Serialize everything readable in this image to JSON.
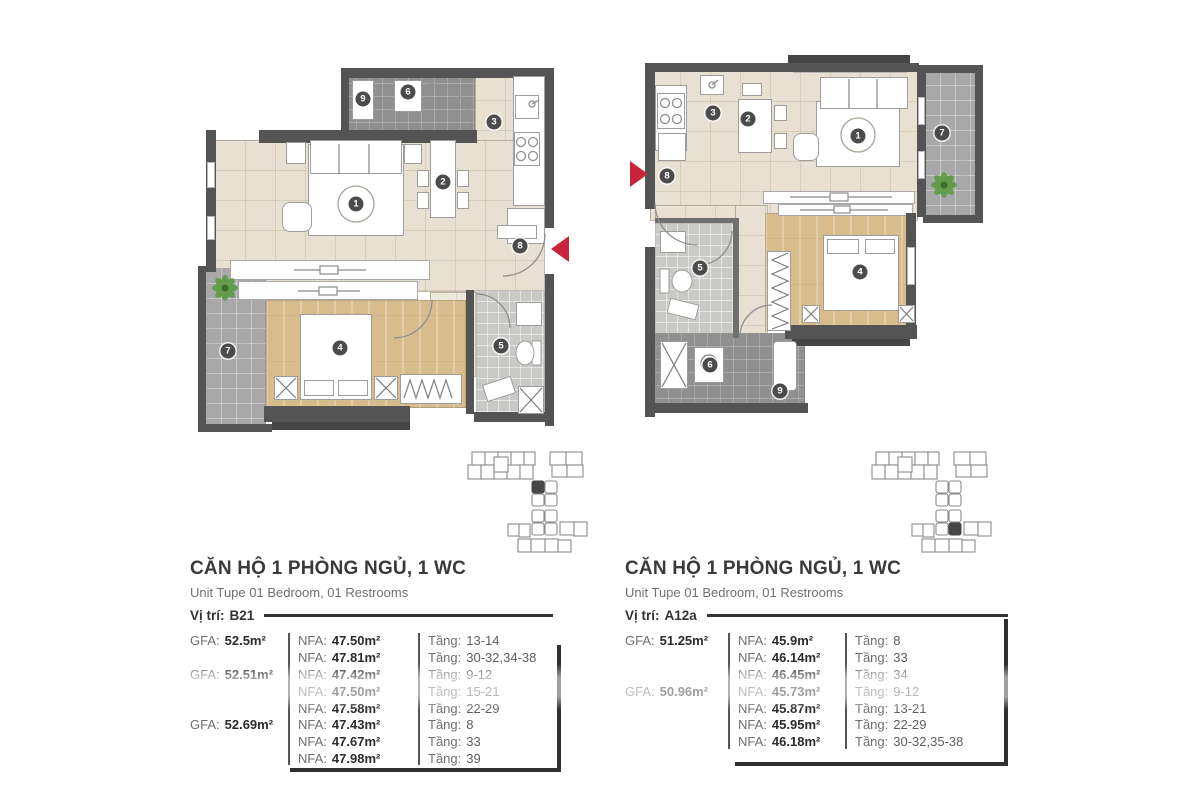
{
  "palette": {
    "wall": "#545454",
    "floor_beige": "#e8e1d3",
    "floor_wood": "#d9bc8d",
    "floor_balcony": "#a8a8a8",
    "floor_utility": "#909090",
    "floor_bath": "#c9cac6",
    "accent_red": "#c9243a",
    "plant_green": "#5c9a44",
    "text_dark": "#2b2b2b",
    "text_gray": "#6f6f6f"
  },
  "units": [
    {
      "title": "CĂN HỘ 1 PHÒNG NGỦ, 1 WC",
      "subtitle": "Unit Tupe 01 Bedroom, 01 Restrooms",
      "location_label": "Vị trí:",
      "location": "B21",
      "gfa_label": "GFA:",
      "nfa_label": "NFA:",
      "floor_label": "Tầng:",
      "gfa": [
        "52.5m²",
        "52.51m²",
        "52.69m²"
      ],
      "rows": [
        {
          "nfa": "47.50m²",
          "floors": "13-14"
        },
        {
          "nfa": "47.81m²",
          "floors": "30-32,34-38"
        },
        {
          "nfa": "47.42m²",
          "floors": "9-12"
        },
        {
          "nfa": "47.50m²",
          "floors": "15-21"
        },
        {
          "nfa": "47.58m²",
          "floors": "22-29"
        },
        {
          "nfa": "47.43m²",
          "floors": "8"
        },
        {
          "nfa": "47.67m²",
          "floors": "33"
        },
        {
          "nfa": "47.98m²",
          "floors": "39"
        }
      ],
      "badges": [
        "1",
        "2",
        "3",
        "4",
        "5",
        "6",
        "7",
        "8",
        "9"
      ]
    },
    {
      "title": "CĂN HỘ 1 PHÒNG NGỦ, 1 WC",
      "subtitle": "Unit Tupe 01 Bedroom, 01 Restrooms",
      "location_label": "Vị trí:",
      "location": "A12a",
      "gfa_label": "GFA:",
      "nfa_label": "NFA:",
      "floor_label": "Tầng:",
      "gfa": [
        "51.25m²",
        "50.96m²"
      ],
      "rows": [
        {
          "nfa": "45.9m²",
          "floors": "8"
        },
        {
          "nfa": "46.14m²",
          "floors": "33"
        },
        {
          "nfa": "46.45m²",
          "floors": "34"
        },
        {
          "nfa": "45.73m²",
          "floors": "9-12"
        },
        {
          "nfa": "45.87m²",
          "floors": "13-21"
        },
        {
          "nfa": "45.95m²",
          "floors": "22-29"
        },
        {
          "nfa": "46.18m²",
          "floors": "30-32,35-38"
        }
      ],
      "badges": [
        "1",
        "2",
        "3",
        "4",
        "5",
        "6",
        "7",
        "8",
        "9"
      ]
    }
  ]
}
